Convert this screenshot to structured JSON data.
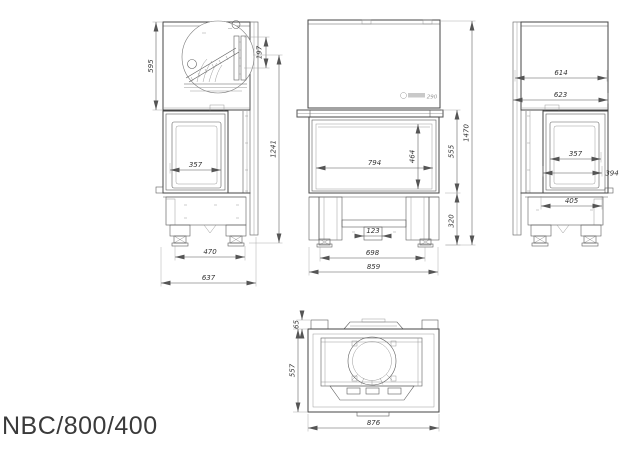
{
  "title": "NBC/800/400",
  "logo": {
    "number": "290"
  },
  "drawing": {
    "kind": "fireplace-insert-dimension-drawing",
    "units": "mm",
    "views": {
      "side_left": {
        "name": "left side view",
        "dims": {
          "top_box_height": "595",
          "deflector_detail": "197",
          "outlet_height": "1241",
          "side_glass_width": "357",
          "feet_spacing": "470",
          "overall_depth": "637"
        }
      },
      "front": {
        "name": "front view",
        "dims": {
          "glass_width": "794",
          "glass_height": "464",
          "door_height": "555",
          "overall_height": "1470",
          "base_height": "320",
          "center_duct_width": "123",
          "feet_spacing": "698",
          "overall_width": "859"
        }
      },
      "side_right": {
        "name": "right side view",
        "dims": {
          "top_depth": "614",
          "overall_depth": "623",
          "side_glass_width": "357",
          "glass_depth": "394",
          "base_depth": "405"
        }
      },
      "plan": {
        "name": "top view",
        "dims": {
          "collar_height": "65",
          "body_depth": "557",
          "overall_width": "876"
        }
      }
    }
  }
}
